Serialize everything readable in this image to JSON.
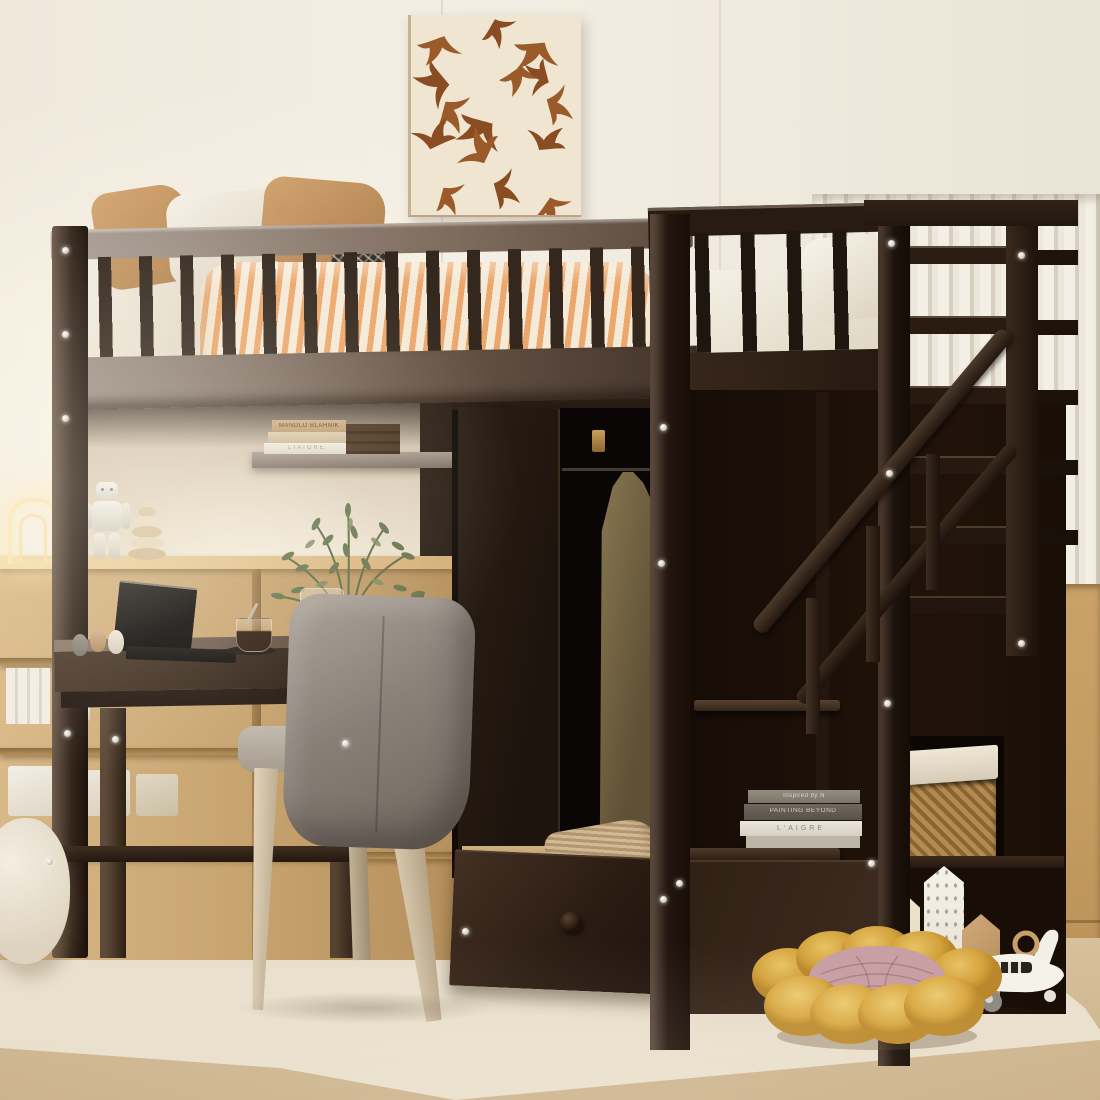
{
  "scene": {
    "type": "product-photo",
    "subject": "Espresso twin loft bed with desk, wardrobe, storage staircase and drawers in a beige kids bedroom"
  },
  "wall_art": {
    "description": "abstract flying-swallow pattern canvas",
    "bird_color": "#9b5a29",
    "canvas_color": "#efe5d0"
  },
  "books_on_shelf": {
    "spine_top": "MANOLO BLAHNIK",
    "spine_bottom": "LIAIGRE"
  },
  "books_on_stairs": {
    "spine_1": "Inspired by N",
    "spine_2": "PAINTING BEYOND",
    "spine_3": "L'AIGRE"
  },
  "palette": {
    "espresso": "#2b1f17",
    "espresso_lit": "#8a7a6e",
    "wall": "#f1ebe0",
    "slat_wall": "#e9e4d7",
    "wainscot_oak": "#c9a571",
    "floor_wood": "#d2b994",
    "rug": "#ece3d2",
    "pillow_tan": "#c89a6b",
    "duvet_stripe": "#e2a06a",
    "mattress_white": "#f3efe5",
    "chair_upholstery": "#8f867f",
    "chair_leg": "#d8cab2",
    "basket_rattan": "#b0854c",
    "pouf_yellow": "#d9a844",
    "pouf_center_pink": "#c79fa4",
    "plant_green": "#66744d",
    "lamp_glow": "#ffe9b8"
  },
  "objects": [
    "loft-bed",
    "guard-rail",
    "staircase-storage",
    "handrail",
    "wardrobe",
    "hanging-coat",
    "desk",
    "laptop",
    "coffee-glass",
    "olive-plant",
    "office-chair",
    "bookshelf",
    "robot-figurine",
    "stacking-toy",
    "arch-lamp",
    "wicker-basket",
    "storage-drawer",
    "corduroy-pillow",
    "flower-floor-cushion",
    "toy-houses",
    "toy-airplane",
    "floor-pouf",
    "area-rug",
    "wall-art"
  ]
}
